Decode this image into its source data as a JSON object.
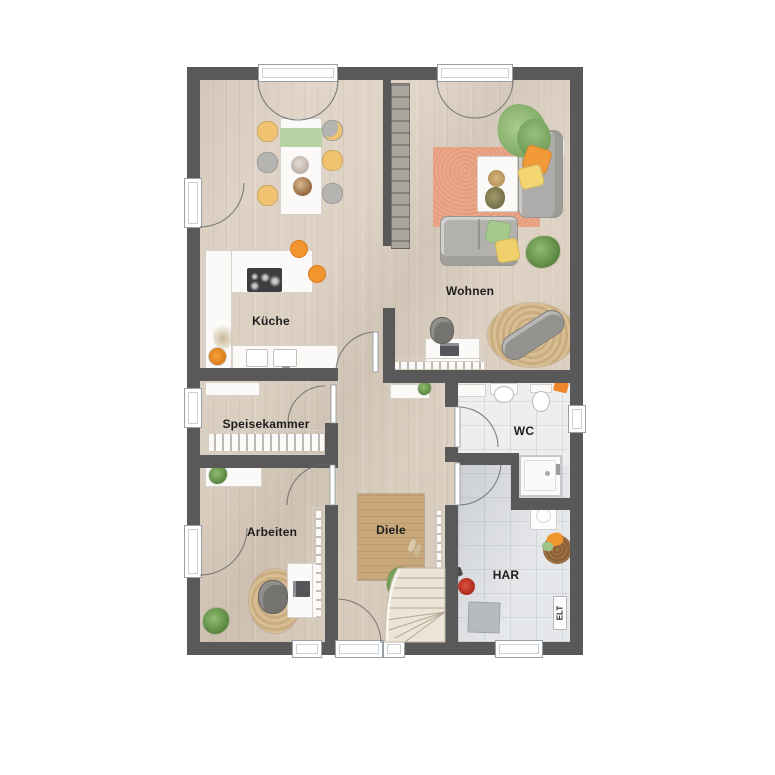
{
  "rooms": {
    "kueche": "Küche",
    "wohnen": "Wohnen",
    "speisekammer": "Speisekammer",
    "arbeiten": "Arbeiten",
    "diele": "Diele",
    "wc": "WC",
    "har": "HAR",
    "elt": "ELT"
  },
  "colors": {
    "wall": "#595959",
    "floor_wood": "#dbcfc1",
    "floor_tile": "#eceef0",
    "rug_living": "#eba78a",
    "rug_jute": "#d4b88e",
    "rug_wood": "#c8a87a",
    "accent_orange": "#f2952f",
    "accent_yellow": "#f3d572",
    "accent_green": "#96c07c",
    "stairs": "#ece4d6"
  }
}
